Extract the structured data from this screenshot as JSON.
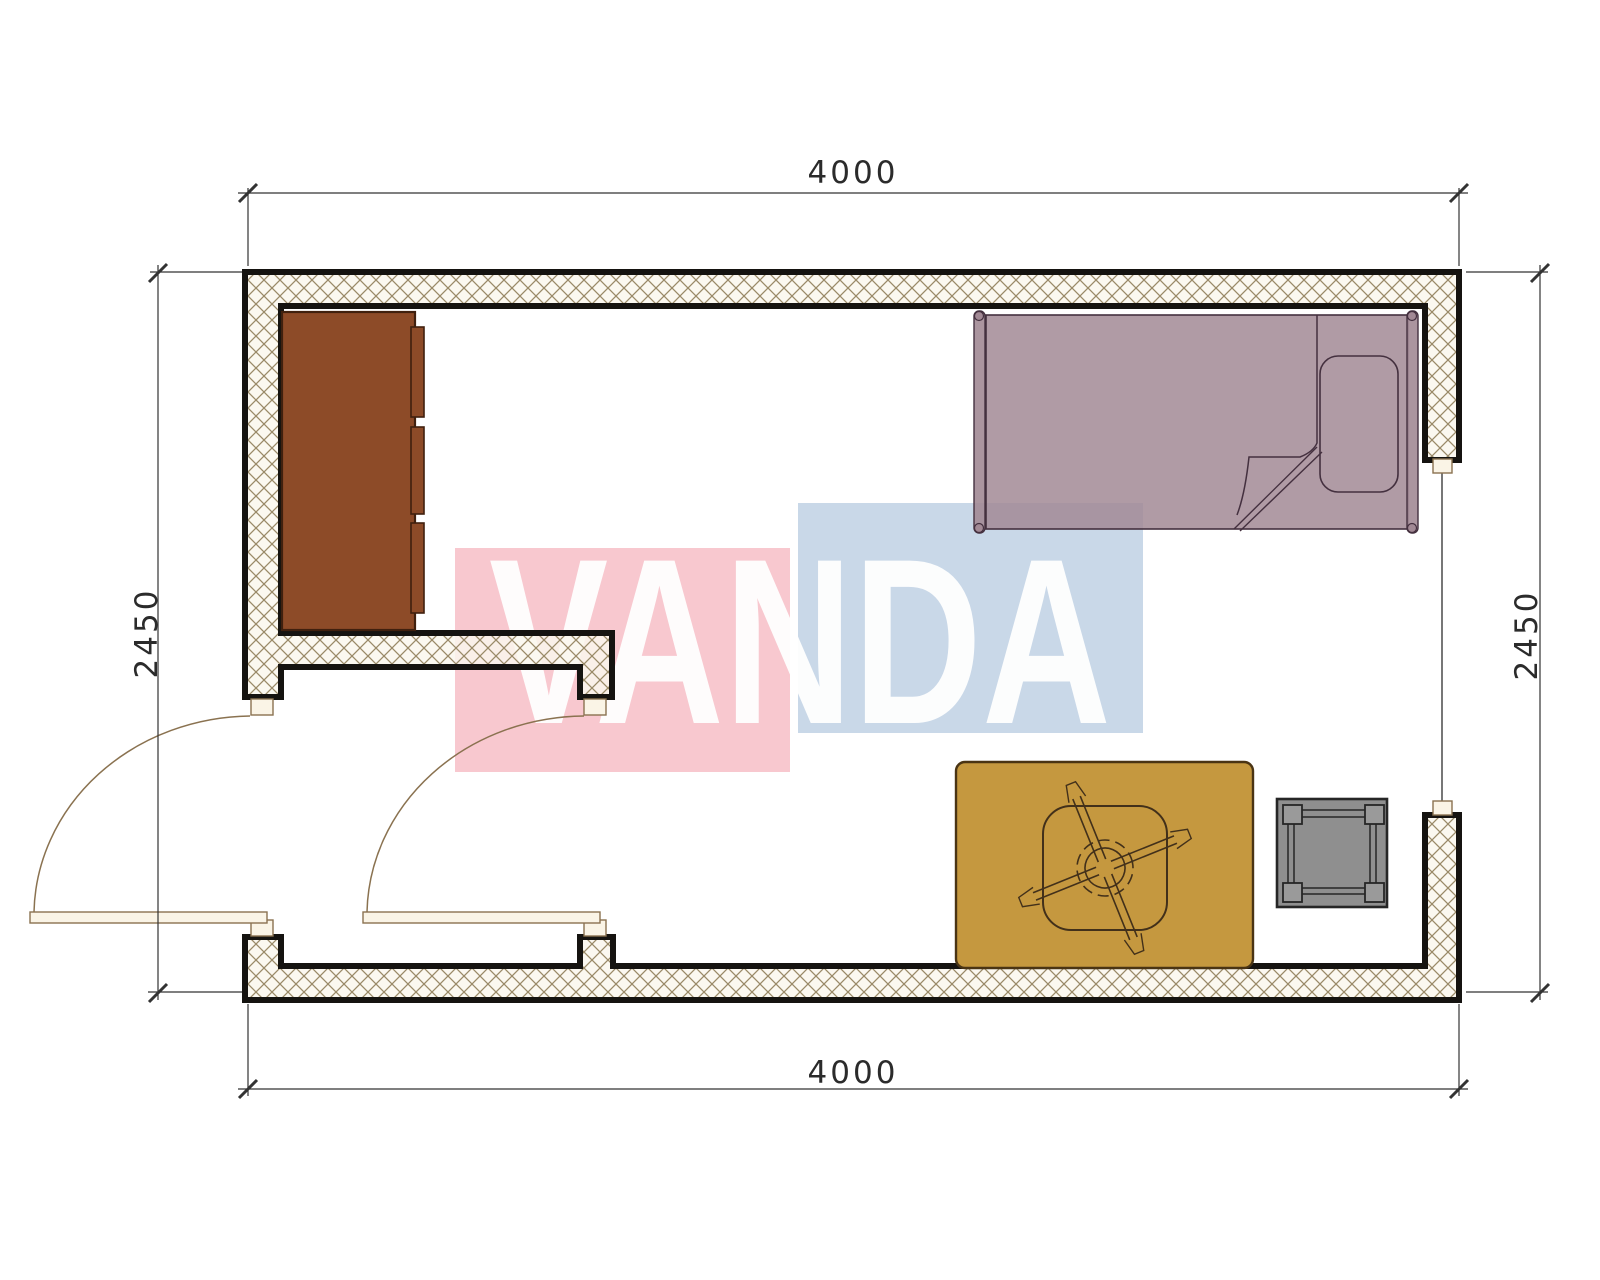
{
  "plan": {
    "title": "room-floor-plan",
    "dimensions": {
      "top": "4000",
      "bottom": "4000",
      "left": "2450",
      "right": "2450"
    },
    "watermark": {
      "text": "VANDA",
      "pink_square_color": "#f8c8cf",
      "blue_square_color": "#c9d8e8",
      "text_color": "#ffffff"
    },
    "colors": {
      "wall_stroke": "#151310",
      "wall_hatch_line": "#9a8a68",
      "wall_hatch_bg": "#fbf7ee",
      "door_line": "#8a7250",
      "door_leaf_fill": "#faf4e6",
      "wardrobe": "#8d4b28",
      "wardrobe_stroke": "#40200e",
      "bed": "#a28995",
      "bed_stroke": "#44303f",
      "rug": "#c5983f",
      "rug_stroke": "#4a3414",
      "chair_stroke": "#42301a",
      "stool": "#8f8f8f",
      "stool_stroke": "#262626",
      "dimension_line": "#333333"
    },
    "items": [
      {
        "name": "wardrobe",
        "label": "wardrobe with sliding doors"
      },
      {
        "name": "single-bed",
        "label": "single bed with pillow and folded blanket"
      },
      {
        "name": "rug",
        "label": "rug / carpet"
      },
      {
        "name": "office-chair",
        "label": "swivel chair on casters"
      },
      {
        "name": "stool",
        "label": "small stool / side table"
      },
      {
        "name": "window",
        "label": "window in right wall"
      },
      {
        "name": "entry-door",
        "label": "exterior door with swing arc"
      },
      {
        "name": "interior-door",
        "label": "interior door with swing arc"
      }
    ]
  }
}
